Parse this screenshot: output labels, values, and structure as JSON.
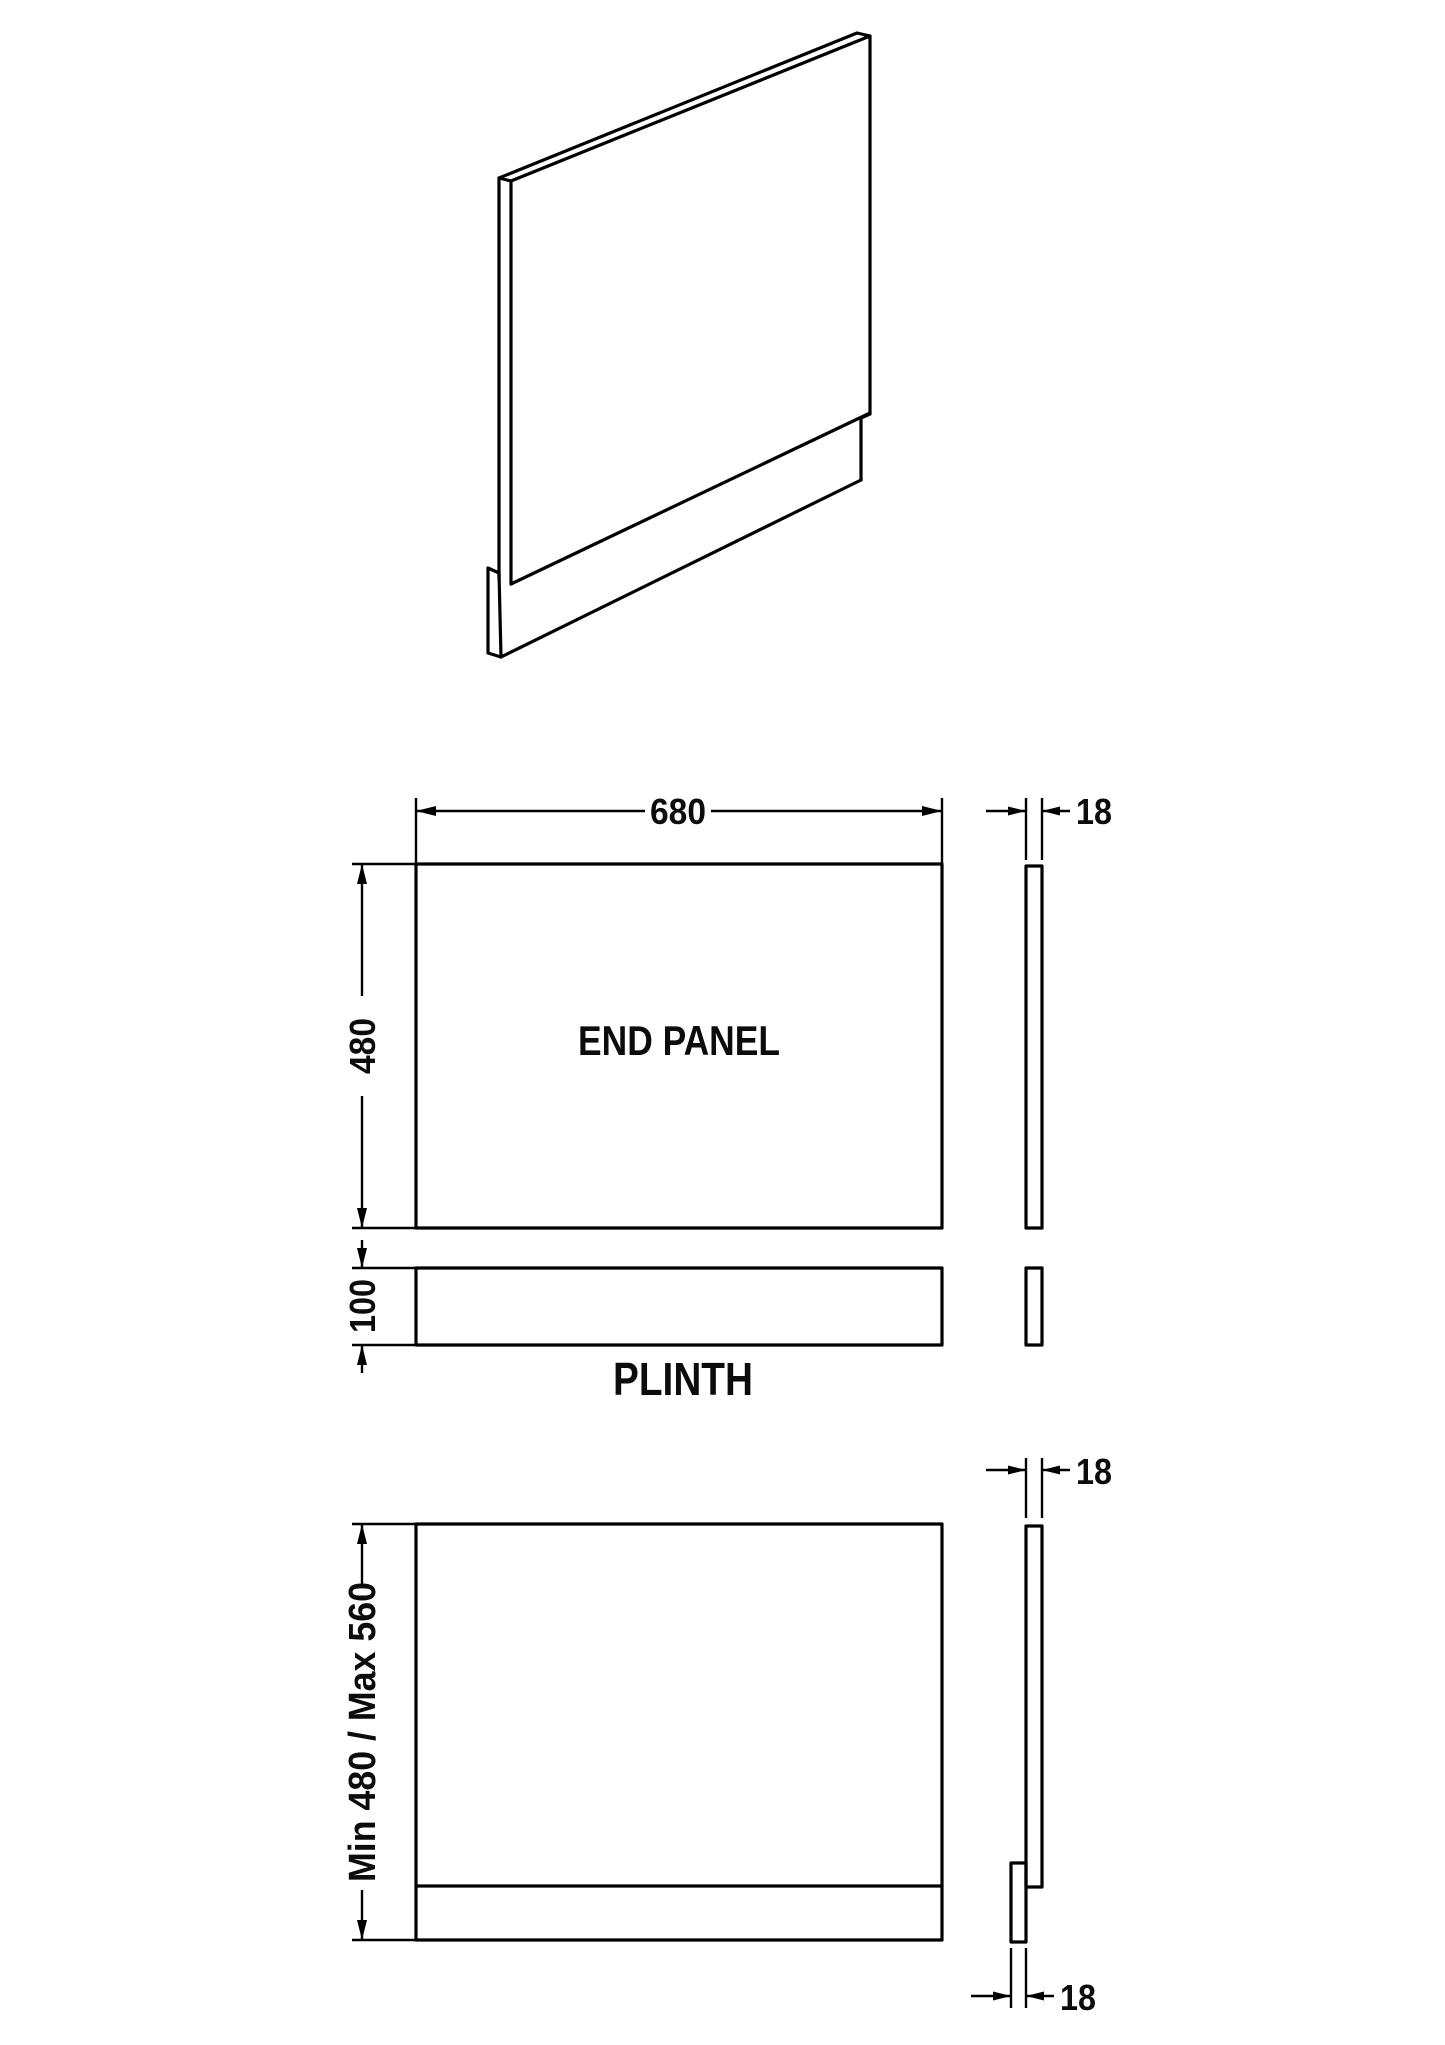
{
  "drawing": {
    "front_view": {
      "label": "END PANEL",
      "width_dim": "680",
      "height_dim": "480",
      "thickness_dim": "18"
    },
    "plinth_view": {
      "label": "PLINTH",
      "height_dim": "100"
    },
    "assembled_view": {
      "height_dim": "Min 480 / Max 560",
      "panel_thickness_dim": "18",
      "plinth_thickness_dim": "18"
    },
    "colors": {
      "line": "#000000",
      "text": "#0c0c0c",
      "background": "#ffffff"
    }
  }
}
